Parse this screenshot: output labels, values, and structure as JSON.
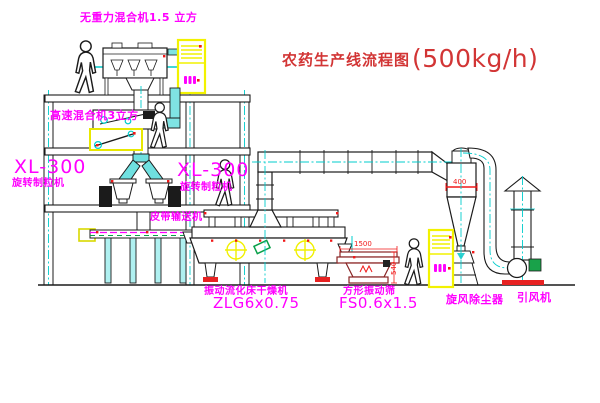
{
  "title": {
    "text_zh": "农药生产线流程图",
    "capacity": "(500kg/h)"
  },
  "floor_labels": {
    "top_mixer": "无重力混合机1.5 立方",
    "second_mixer": "高速混合机3立方",
    "left_granulator_model": "XL-300",
    "left_granulator_name": "旋转制粒机",
    "mid_granulator_model": "XL-300",
    "mid_granulator_name": "旋转制粒机",
    "belt_conveyor": "皮带输送机"
  },
  "equipment_labels": {
    "dryer_name": "振动流化床干燥机",
    "dryer_model": "ZLG6x0.75",
    "screen_name": "方形振动筛",
    "screen_model": "FS0.6x1.5",
    "cyclone_name": "旋风除尘器",
    "fan_name": "引风机"
  },
  "dimensions": {
    "screen_length": "1500",
    "screen_height": "540",
    "cyclone_band": "400"
  },
  "colors": {
    "label_magenta": "#ff00ff",
    "title_red": "#d23535",
    "dim_red": "#f01818",
    "centerline_cyan": "#00cccc",
    "highlight_yellow": "#f2f200",
    "machine_green": "#0aa04a",
    "screen_maroon": "#8a2525",
    "line_black": "#1b1b1b"
  }
}
